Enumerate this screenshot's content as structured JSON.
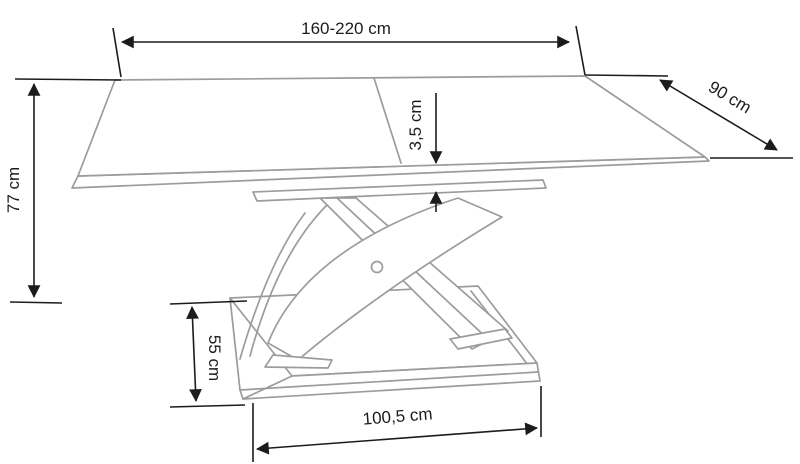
{
  "page": {
    "background": "#ffffff"
  },
  "diagram": {
    "style": {
      "furniture_line_color": "#9c9c9c",
      "dimension_line_color": "#1c1c1c"
    },
    "dimensions": {
      "table_width": {
        "label": "160-220 cm"
      },
      "table_depth": {
        "label": "90 cm"
      },
      "table_height": {
        "label": "77 cm"
      },
      "top_thickness": {
        "label": "3,5 cm"
      },
      "base_depth": {
        "label": "55 cm"
      },
      "base_width": {
        "label": "100,5 cm"
      }
    }
  }
}
